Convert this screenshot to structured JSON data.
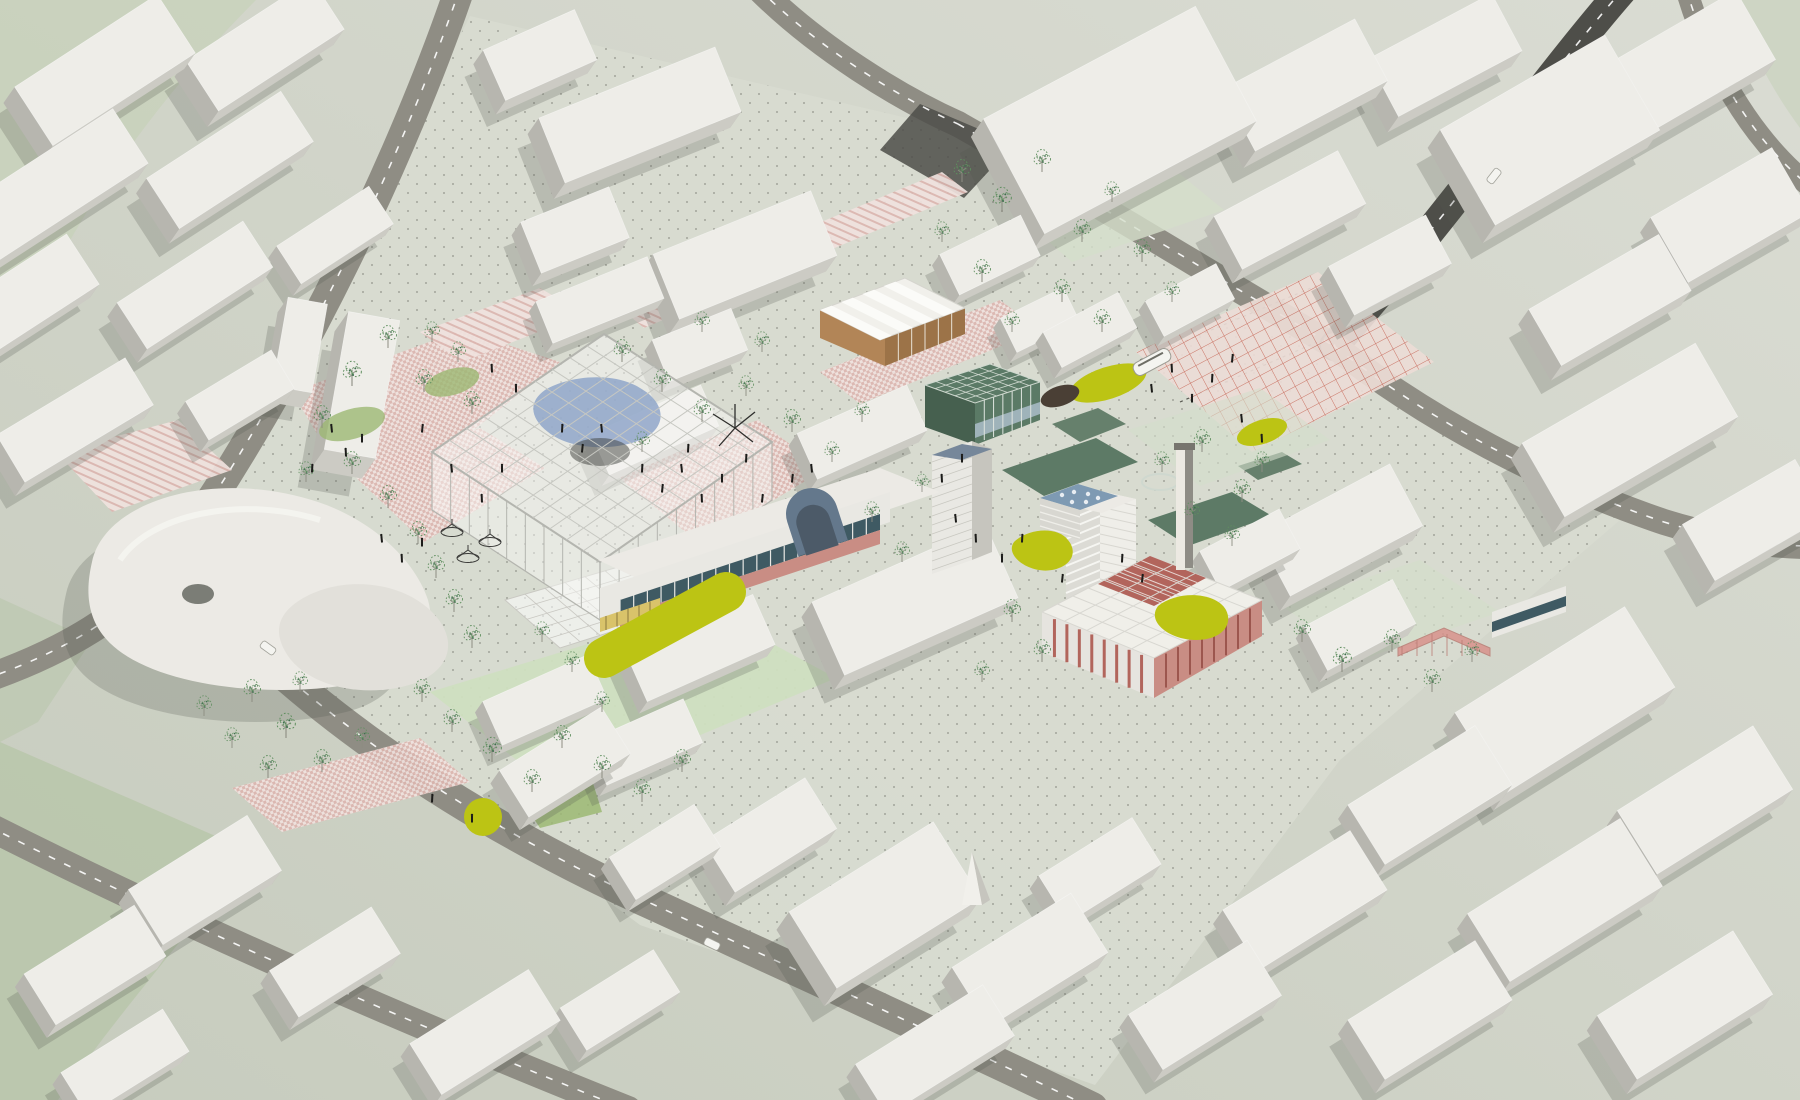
{
  "meta": {
    "title": "Aerial axonometric urban masterplan rendering",
    "description": "3D bird's-eye visualization of a city-centre redevelopment: white context massing, ring roads, central glasshouse canopy, pink paved plazas, chartreuse lawn accents, red factory hall, slab tower, market hall and scattered sketch trees",
    "style": "architectural-visualization"
  },
  "palette": {
    "bgLight": "#dadcd3",
    "bgDark": "#c7ccbe",
    "campus": "#d8dbd0",
    "terrain": "#b9c6ac",
    "terrain2": "#c7d1ba",
    "road": "#8f8d84",
    "roadDark": "#4e4e49",
    "roadLine": "#ffffff",
    "blockTop": "#eeede8",
    "blockTopInner": "#f2f1ec",
    "blockSideA": "#cccbc4",
    "blockSideB": "#b7b6af",
    "shadow": "rgba(84,86,78,0.24)",
    "pinkBg": "#f0e2de",
    "pinkCheck": "#dcb6b0",
    "redLine": "#c96a5b",
    "gridBg": "#ecdcd6",
    "chartreuse": "#bcc414",
    "soil": "#4a3f35",
    "glassFrame": "#b4b5af",
    "glassFill": "rgba(247,247,245,0.5)",
    "glassBlue": "#8fa6c9",
    "glassDark": "rgba(62,64,60,0.5)",
    "teal": "#5b7a66",
    "tealDark": "#46604f",
    "glaze": "#3f5a63",
    "blueRoof": "#7e9ab3",
    "vault": "#64788c",
    "vaultDark": "#4c5a68",
    "brick": "#b2655c",
    "brickLight": "#c98d84",
    "salmon": "#d8938c",
    "tan": "#b28557",
    "tanDark": "#9c7348",
    "yellowBand": "#d9c36a",
    "treeGreen": "#5f8f5f",
    "treeTrunk": "#8d8d82",
    "treeDot": "#3f6f4f",
    "lawn": "#9cb873",
    "lawnLight": "#cfdfc0",
    "lawnPale": "#d4decb",
    "court": "#5d7a66",
    "court2": "#66806c",
    "people": "#1c1c1a",
    "dot": "#4a4c44",
    "white": "#f4f4f0",
    "chimneyLit": "#ece9e2",
    "chimneyShade": "#8e8c85"
  },
  "scene": {
    "campusOutline": "470,16 950,128 1332,344 1620,520 1340,760 1095,1085 640,925 168,576 300,352",
    "terrain": [
      {
        "d": "M0,742 L252,852 C186,936 118,1014 58,1100 L0,1100 Z",
        "f": "terrain",
        "o": 0.9
      },
      {
        "d": "M0,0 L256,0 C184,72 120,152 68,244 L0,306 Z",
        "f": "terrain2",
        "o": 0.75
      },
      {
        "d": "M1736,0 L1800,0 L1800,128 C1768,84 1748,44 1736,0 Z",
        "f": "terrain2",
        "o": 0.6
      },
      {
        "d": "M0,598 L92,640 L38,722 L0,742 Z",
        "f": "terrain",
        "o": 0.6
      }
    ],
    "roads": [
      {
        "d": "M460,-12 C405,150 300,375 172,558",
        "w": 30,
        "dark": false
      },
      {
        "d": "M172,558 C128,615 62,652 -12,678",
        "w": 28,
        "dark": false
      },
      {
        "d": "M172,558 C268,680 430,802 648,902 C840,990 1010,1068 1092,1108",
        "w": 32,
        "dark": false
      },
      {
        "d": "M-12,826 C190,928 408,1022 628,1110",
        "w": 28,
        "dark": false
      },
      {
        "d": "M758,-12 C818,48 900,98 958,124",
        "w": 26,
        "dark": false
      },
      {
        "d": "M958,124 C1092,200 1224,282 1334,346",
        "w": 26,
        "dark": false
      },
      {
        "d": "M1624,-12 C1542,82 1458,204 1334,346",
        "w": 30,
        "dark": true
      },
      {
        "d": "M1334,346 C1428,420 1546,482 1664,522 C1722,540 1770,546 1812,546",
        "w": 26,
        "dark": false
      },
      {
        "d": "M1686,-12 C1706,58 1748,138 1812,188",
        "w": 22,
        "dark": false
      }
    ],
    "roadPatches": [
      {
        "d": "M920,104 L1014,144 L964,198 L880,150 Z"
      }
    ],
    "tramTracks": [
      "M1140,360 L1330,280",
      "M1180,402 L1372,318"
    ],
    "plazas": [
      {
        "pts": "292,392 462,330 560,362 420,472 328,452",
        "pat": "check"
      },
      {
        "pts": "348,470 480,428 545,468 424,542",
        "pat": "check"
      },
      {
        "pts": "56,452 178,420 232,470 112,512",
        "pat": "stripe"
      },
      {
        "pts": "612,472 758,420 824,470 700,544",
        "pat": "check"
      },
      {
        "pts": "820,372 1000,300 1040,330 860,404",
        "pat": "check"
      },
      {
        "pts": "1136,352 1318,272 1434,362 1252,452",
        "pat": "grid"
      },
      {
        "pts": "232,788 420,738 470,782 282,832",
        "pat": "check"
      },
      {
        "pts": "420,332 540,288 584,314 462,362",
        "pat": "stripe"
      },
      {
        "pts": "618,306 942,172 968,192 644,328",
        "pat": "stripe"
      }
    ],
    "lawnPatches": [
      {
        "pts": "430,692 706,608 836,678 560,794",
        "f": "lawnLight",
        "o": 0.95
      },
      {
        "pts": "996,196 1148,148 1224,210 1072,262",
        "f": "lawnPale",
        "o": 0.8
      },
      {
        "pts": "1282,606 1420,560 1500,612 1360,660",
        "f": "lawnPale",
        "o": 0.7
      },
      {
        "pts": "1128,430 1260,388 1330,440 1200,486",
        "f": "lawnPale",
        "o": 0.6
      },
      {
        "pts": "520,798 592,780 602,812 540,828",
        "f": "lawn",
        "o": 0.85
      }
    ],
    "courts": [
      {
        "pts": "1002,470 1096,438 1138,462 1044,496",
        "f": "court"
      },
      {
        "pts": "1052,424 1098,408 1126,424 1080,442",
        "f": "court2"
      },
      {
        "pts": "1148,520 1232,492 1272,516 1188,546",
        "f": "court"
      },
      {
        "pts": "1238,466 1282,452 1302,464 1258,480",
        "f": "court2"
      }
    ],
    "blocks": [
      [
        265,
        45,
        150,
        60,
        -33,
        1.6
      ],
      [
        105,
        70,
        170,
        70,
        -33,
        1.6
      ],
      [
        1445,
        55,
        140,
        65,
        -28,
        1.6
      ],
      [
        540,
        55,
        100,
        55,
        -24,
        1.4
      ],
      [
        1695,
        60,
        140,
        80,
        -30,
        1.6
      ],
      [
        1305,
        85,
        150,
        70,
        -28,
        1.7
      ],
      [
        640,
        115,
        190,
        70,
        -22,
        1.6
      ],
      [
        1120,
        120,
        240,
        130,
        -28,
        1.8
      ],
      [
        1550,
        130,
        190,
        110,
        -30,
        1.8
      ],
      [
        230,
        160,
        160,
        60,
        -33,
        1.5
      ],
      [
        55,
        185,
        180,
        65,
        -33,
        1.5
      ],
      [
        1290,
        210,
        140,
        60,
        -28,
        1.4
      ],
      [
        1730,
        215,
        140,
        75,
        -30,
        1.5
      ],
      [
        575,
        230,
        95,
        55,
        -22,
        1.3
      ],
      [
        335,
        235,
        110,
        45,
        -33,
        1.2
      ],
      [
        745,
        255,
        170,
        70,
        -22,
        1.6
      ],
      [
        990,
        255,
        90,
        45,
        -26,
        1.1
      ],
      [
        20,
        300,
        150,
        60,
        -33,
        1.4
      ],
      [
        600,
        300,
        120,
        45,
        -22,
        1.0
      ],
      [
        1610,
        300,
        150,
        65,
        -30,
        1.5
      ],
      [
        1190,
        300,
        80,
        40,
        -28,
        1.0
      ],
      [
        195,
        285,
        150,
        55,
        -33,
        1.4
      ],
      [
        1090,
        330,
        85,
        40,
        -28,
        1.1
      ],
      [
        1040,
        320,
        70,
        38,
        -26,
        1.0
      ],
      [
        1390,
        265,
        110,
        55,
        -28,
        1.3
      ],
      [
        300,
        345,
        40,
        90,
        10,
        1.5
      ],
      [
        700,
        345,
        85,
        45,
        -22,
        1.1
      ],
      [
        362,
        385,
        52,
        140,
        10,
        2.0
      ],
      [
        240,
        395,
        100,
        45,
        -31,
        1.2
      ],
      [
        75,
        420,
        150,
        55,
        -31,
        1.4
      ],
      [
        655,
        430,
        120,
        45,
        -24,
        1.1
      ],
      [
        862,
        432,
        120,
        50,
        -24,
        1.2
      ],
      [
        1630,
        430,
        200,
        85,
        -30,
        1.6
      ],
      [
        1340,
        530,
        150,
        70,
        -28,
        1.5
      ],
      [
        1755,
        520,
        130,
        65,
        -30,
        1.4
      ],
      [
        1250,
        550,
        90,
        45,
        -28,
        1.1
      ],
      [
        915,
        600,
        190,
        80,
        -24,
        1.5
      ],
      [
        1360,
        625,
        100,
        50,
        -28,
        1.2
      ],
      [
        700,
        648,
        140,
        55,
        -24,
        1.2
      ],
      [
        545,
        700,
        115,
        48,
        -24,
        1.1
      ],
      [
        1565,
        700,
        200,
        95,
        -32,
        1.7
      ],
      [
        645,
        742,
        105,
        48,
        -24,
        1.1
      ],
      [
        565,
        762,
        120,
        55,
        -32,
        1.3
      ],
      [
        1430,
        795,
        150,
        70,
        -32,
        1.4
      ],
      [
        1705,
        800,
        160,
        75,
        -32,
        1.5
      ],
      [
        232,
        788,
        0,
        0,
        0,
        0
      ],
      [
        770,
        835,
        120,
        60,
        -32,
        1.4
      ],
      [
        665,
        852,
        100,
        50,
        -32,
        1.2
      ],
      [
        205,
        880,
        140,
        65,
        -32,
        1.4
      ],
      [
        1100,
        870,
        110,
        55,
        -32,
        1.3
      ],
      [
        1305,
        900,
        150,
        70,
        -32,
        1.4
      ],
      [
        885,
        905,
        170,
        90,
        -32,
        1.8
      ],
      [
        1565,
        900,
        180,
        80,
        -32,
        1.5
      ],
      [
        95,
        965,
        130,
        60,
        -32,
        1.3
      ],
      [
        335,
        962,
        120,
        55,
        -32,
        1.3
      ],
      [
        1030,
        960,
        140,
        70,
        -32,
        1.5
      ],
      [
        620,
        1000,
        110,
        50,
        -32,
        1.2
      ],
      [
        1205,
        1005,
        140,
        65,
        -32,
        1.3
      ],
      [
        1685,
        1005,
        160,
        75,
        -32,
        1.5
      ],
      [
        485,
        1032,
        140,
        60,
        -32,
        1.3
      ],
      [
        1430,
        1010,
        150,
        70,
        -32,
        1.4
      ],
      [
        935,
        1050,
        150,
        60,
        -32,
        1.3
      ],
      [
        125,
        1062,
        120,
        50,
        -32,
        1.2
      ]
    ],
    "accents": [
      {
        "t": "capsule",
        "x1": 604,
        "y1": 658,
        "x2": 726,
        "y2": 592,
        "r": 20,
        "f": "chartreuse"
      },
      {
        "t": "circle",
        "x": 483,
        "y": 817,
        "r": 19,
        "f": "chartreuse"
      },
      {
        "t": "ellipse",
        "x": 1108,
        "y": 383,
        "rx": 40,
        "ry": 16,
        "rot": -18,
        "f": "chartreuse"
      },
      {
        "t": "ellipse",
        "x": 1262,
        "y": 432,
        "rx": 26,
        "ry": 12,
        "rot": -18,
        "f": "chartreuse"
      },
      {
        "t": "blob",
        "d": "M1014,542 C1028,528 1058,526 1068,540 C1078,552 1072,566 1052,570 C1030,574 1004,556 1014,542 Z",
        "f": "chartreuse"
      },
      {
        "t": "blob",
        "d": "M1158,606 C1178,590 1216,592 1226,610 C1234,626 1220,640 1196,640 C1170,640 1146,622 1158,606 Z",
        "f": "chartreuse"
      },
      {
        "t": "ellipse",
        "x": 1060,
        "y": 396,
        "rx": 20,
        "ry": 10,
        "rot": -18,
        "f": "soil"
      },
      {
        "t": "ellipse",
        "x": 352,
        "y": 424,
        "rx": 34,
        "ry": 15,
        "rot": -16,
        "f": "lawn",
        "o": 0.8
      },
      {
        "t": "ellipse",
        "x": 452,
        "y": 382,
        "rx": 28,
        "ry": 13,
        "rot": -16,
        "f": "lawn",
        "o": 0.8
      }
    ],
    "trees": [
      [
        322,
        428,
        1
      ],
      [
        352,
        386,
        1.1
      ],
      [
        388,
        348,
        1
      ],
      [
        424,
        392,
        1
      ],
      [
        458,
        362,
        0.9
      ],
      [
        472,
        414,
        1
      ],
      [
        352,
        474,
        1
      ],
      [
        306,
        482,
        0.9
      ],
      [
        432,
        342,
        0.9
      ],
      [
        388,
        508,
        1
      ],
      [
        418,
        544,
        1
      ],
      [
        436,
        578,
        1
      ],
      [
        454,
        612,
        1
      ],
      [
        472,
        648,
        1
      ],
      [
        252,
        702,
        1
      ],
      [
        286,
        738,
        1.1
      ],
      [
        322,
        772,
        1
      ],
      [
        362,
        748,
        0.9
      ],
      [
        300,
        692,
        0.9
      ],
      [
        204,
        716,
        0.9
      ],
      [
        232,
        748,
        0.9
      ],
      [
        268,
        778,
        1
      ],
      [
        422,
        702,
        1
      ],
      [
        452,
        732,
        1
      ],
      [
        492,
        762,
        1.1
      ],
      [
        532,
        792,
        1
      ],
      [
        562,
        748,
        1
      ],
      [
        602,
        778,
        1
      ],
      [
        642,
        802,
        1
      ],
      [
        682,
        772,
        1
      ],
      [
        622,
        362,
        1
      ],
      [
        662,
        392,
        1
      ],
      [
        702,
        422,
        1
      ],
      [
        746,
        396,
        0.9
      ],
      [
        792,
        432,
        1
      ],
      [
        832,
        462,
        0.9
      ],
      [
        862,
        422,
        0.9
      ],
      [
        642,
        452,
        0.9
      ],
      [
        702,
        332,
        0.9
      ],
      [
        762,
        352,
        0.9
      ],
      [
        962,
        182,
        1
      ],
      [
        1002,
        212,
        1.1
      ],
      [
        1042,
        172,
        1
      ],
      [
        1082,
        242,
        1
      ],
      [
        1112,
        202,
        0.9
      ],
      [
        1062,
        302,
        1
      ],
      [
        1102,
        332,
        1
      ],
      [
        1142,
        262,
        1
      ],
      [
        1172,
        302,
        0.9
      ],
      [
        982,
        282,
        1
      ],
      [
        942,
        242,
        0.9
      ],
      [
        1012,
        332,
        0.9
      ],
      [
        1162,
        472,
        0.9
      ],
      [
        1202,
        452,
        1
      ],
      [
        1242,
        502,
        1
      ],
      [
        1192,
        522,
        0.9
      ],
      [
        1262,
        472,
        0.9
      ],
      [
        1232,
        546,
        0.9
      ],
      [
        1302,
        642,
        1
      ],
      [
        1342,
        672,
        1.1
      ],
      [
        1392,
        652,
        1
      ],
      [
        1432,
        692,
        1
      ],
      [
        1472,
        662,
        0.9
      ],
      [
        1012,
        622,
        1
      ],
      [
        1042,
        662,
        1
      ],
      [
        982,
        682,
        0.9
      ],
      [
        542,
        642,
        0.9
      ],
      [
        572,
        672,
        0.9
      ],
      [
        872,
        522,
        0.9
      ],
      [
        902,
        562,
        0.9
      ],
      [
        602,
        712,
        0.9
      ],
      [
        922,
        492,
        0.8
      ]
    ],
    "people": [
      [
        332,
        432
      ],
      [
        346,
        456
      ],
      [
        362,
        442
      ],
      [
        312,
        472
      ],
      [
        422,
        432
      ],
      [
        452,
        472
      ],
      [
        482,
        502
      ],
      [
        502,
        472
      ],
      [
        642,
        472
      ],
      [
        662,
        492
      ],
      [
        682,
        472
      ],
      [
        702,
        502
      ],
      [
        722,
        482
      ],
      [
        746,
        462
      ],
      [
        762,
        502
      ],
      [
        956,
        522
      ],
      [
        976,
        542
      ],
      [
        1002,
        562
      ],
      [
        1022,
        542
      ],
      [
        1062,
        582
      ],
      [
        1152,
        392
      ],
      [
        1172,
        372
      ],
      [
        1192,
        402
      ],
      [
        1212,
        382
      ],
      [
        1232,
        362
      ],
      [
        382,
        542
      ],
      [
        402,
        562
      ],
      [
        422,
        546
      ],
      [
        562,
        432
      ],
      [
        582,
        452
      ],
      [
        602,
        432
      ],
      [
        942,
        482
      ],
      [
        962,
        462
      ],
      [
        1122,
        562
      ],
      [
        1142,
        582
      ],
      [
        1242,
        422
      ],
      [
        1262,
        442
      ],
      [
        472,
        822
      ],
      [
        432,
        802
      ],
      [
        792,
        482
      ],
      [
        812,
        472
      ],
      [
        492,
        372
      ],
      [
        516,
        392
      ],
      [
        688,
        452
      ]
    ],
    "vehicles": [
      {
        "x": 1152,
        "y": 362,
        "rot": -28,
        "type": "tram"
      },
      {
        "x": 268,
        "y": 648,
        "rot": 36,
        "type": "car"
      },
      {
        "x": 712,
        "y": 944,
        "rot": 26,
        "type": "car"
      },
      {
        "x": 1494,
        "y": 176,
        "rot": -52,
        "type": "car"
      }
    ]
  }
}
